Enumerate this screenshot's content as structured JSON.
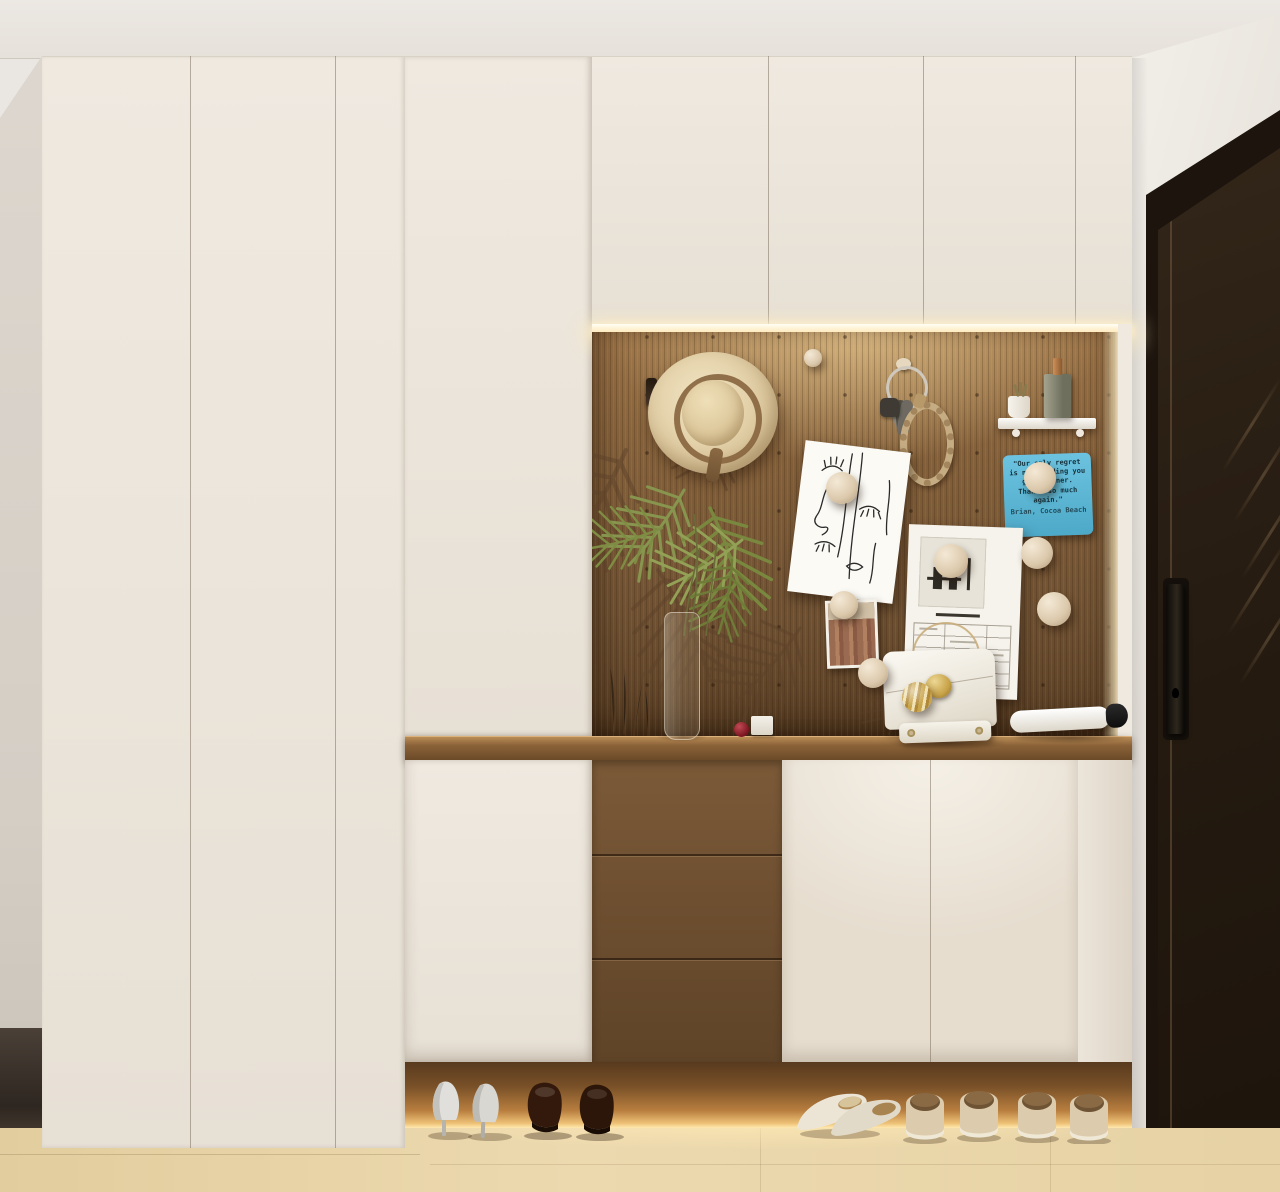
{
  "scene": {
    "title": "Minimalist entryway: white wardrobes, walnut pegboard niche, dark front door",
    "style": "3D interior render"
  },
  "guest_sign": {
    "bg_color": "#57b9d8",
    "text_color": "#16323c",
    "lines": [
      "\"Our only regret",
      "is not finding you",
      "guys sooner.",
      "Thanks so much",
      "again.\"",
      "Brian, Cocoa Beach"
    ]
  },
  "palette": {
    "ceiling": "#eae6e1",
    "cabinet_cream": "#eae3d9",
    "pegboard_wood": "#7d5c39",
    "counter_wood": "#8a6540",
    "drawer_wood": "#6d5032",
    "front_door": "#261c12",
    "floor": "#e7d4a6",
    "led_glow": "#ffe9bd",
    "sign_blue": "#57b9d8"
  },
  "objects": {
    "pegboard_items": [
      "wall-hook",
      "straw-hat",
      "key-ring-with-rope-keychain",
      "floating-shelf",
      "succulent-pot",
      "perfume-bottle",
      "guest-thank-you-sign",
      "line-art-poster",
      "memo-sheet",
      "city-postcard",
      "wooden-peg-balls",
      "palm-mural",
      "palm-arrangement-in-glass-vase"
    ],
    "counter_items": [
      "white-handbag",
      "folded-umbrella",
      "cherry",
      "small-white-box"
    ],
    "floor_items": [
      "white-high-heels",
      "brown-dress-shoes",
      "beige-flats",
      "beige-slippers"
    ]
  }
}
